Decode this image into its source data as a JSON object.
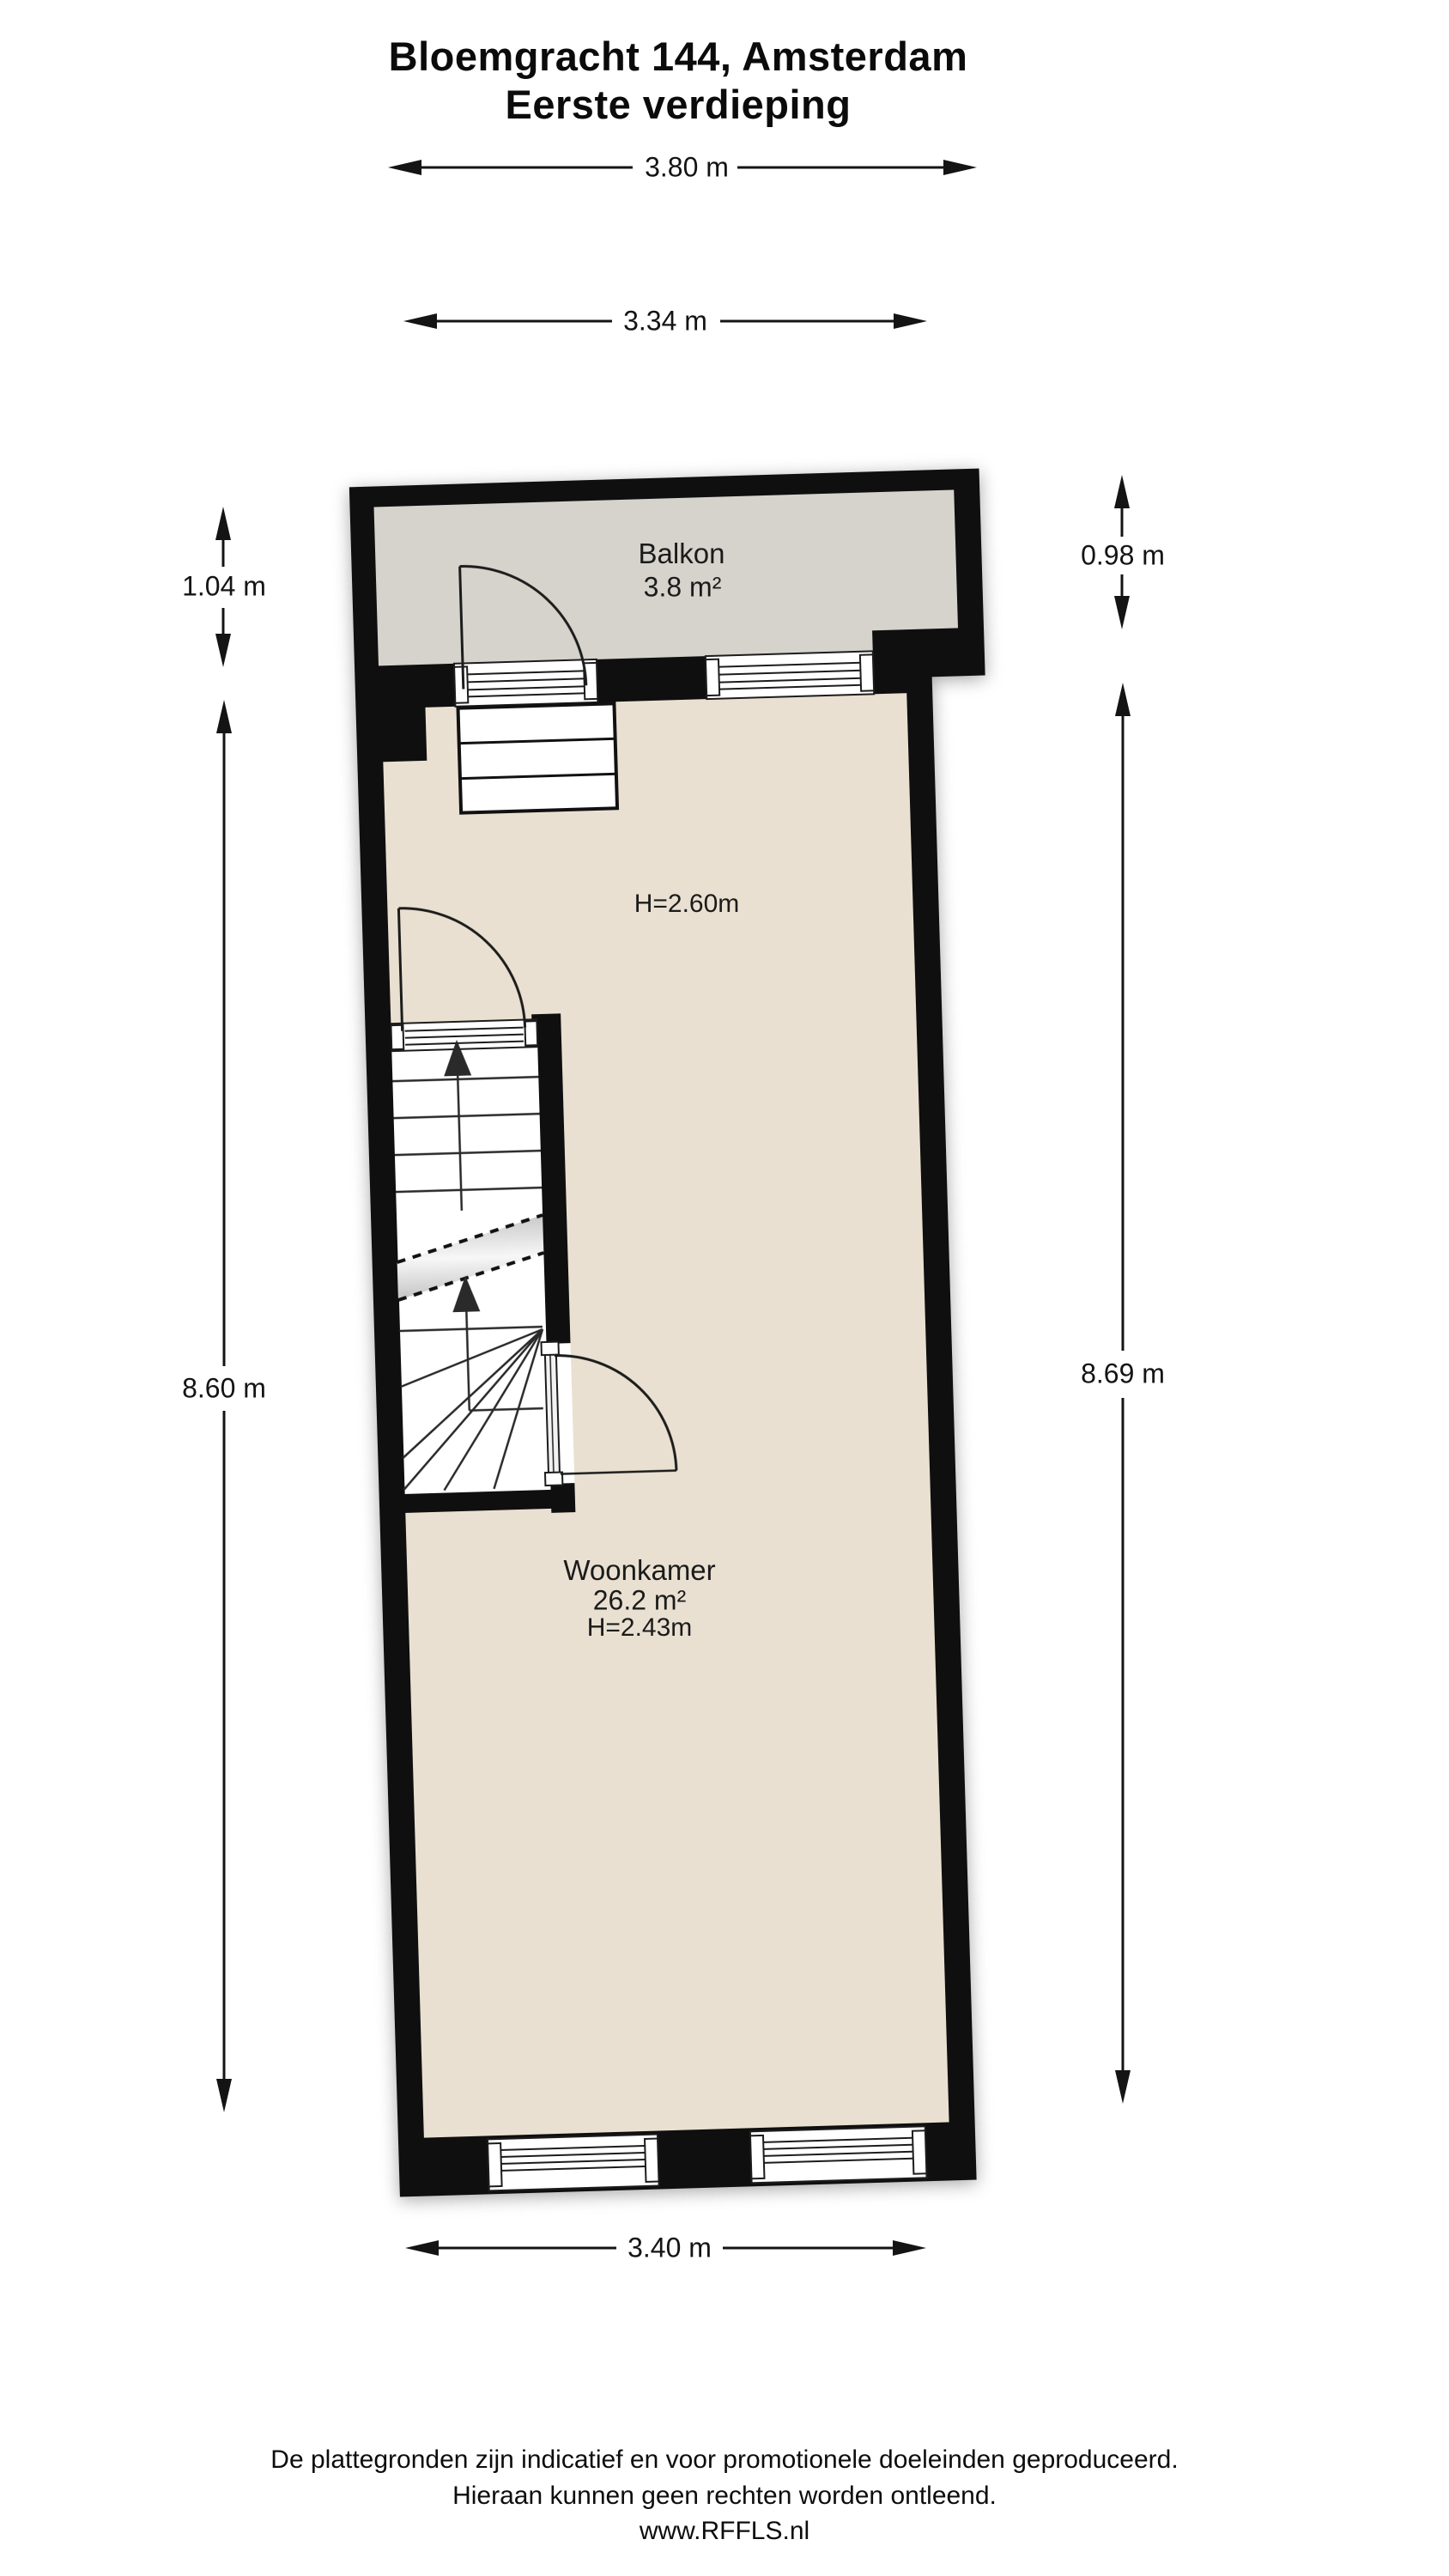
{
  "title": {
    "line1": "Bloemgracht 144, Amsterdam",
    "line2": "Eerste verdieping"
  },
  "dimensions": {
    "top_outer": "3.80 m",
    "top_inner": "3.34 m",
    "balcony_left": "1.04 m",
    "balcony_right": "0.98 m",
    "left_height": "8.60 m",
    "right_height": "8.69 m",
    "bottom_width": "3.40 m"
  },
  "rooms": {
    "balkon": {
      "name": "Balkon",
      "area": "3.8 m²"
    },
    "woonkamer": {
      "name": "Woonkamer",
      "area": "26.2 m²",
      "ceiling_height": "H=2.43m",
      "ceiling_height_front": "H=2.60m"
    }
  },
  "footer": {
    "line1": "De plattegronden zijn indicatief en voor promotionele doeleinden geproduceerd.",
    "line2": "Hieraan kunnen geen rechten worden ontleend.",
    "line3": "www.RFFLS.nl"
  },
  "colors": {
    "wall": "#0f0f0f",
    "balcony_fill": "#d5d3cb",
    "room_fill": "#e9e0d1",
    "line": "#1c1c1c",
    "background": "#ffffff"
  }
}
